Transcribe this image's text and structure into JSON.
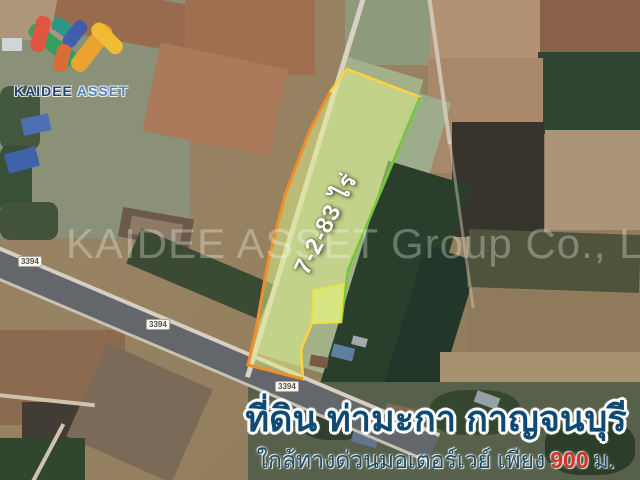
{
  "logo": {
    "brand_primary": "KAIDEE",
    "brand_secondary": "ASSET"
  },
  "watermark": {
    "text": "KAIDEE ASSET Group Co., Ltd."
  },
  "map": {
    "type": "satellite-aerial-photo",
    "road_labels": [
      {
        "text": "3394"
      },
      {
        "text": "3394"
      },
      {
        "text": "3394"
      }
    ],
    "plot": {
      "area_label": "7-2-83 ไร่",
      "fill_color": "#e0f08c",
      "border_top_color": "#ffd23e",
      "border_left_color": "#f08e2a",
      "border_right_color": "#6cc83c"
    }
  },
  "banner": {
    "title": "ที่ดิน ท่ามะกา กาญจนบุรี",
    "subtitle_prefix": "ใกล้ทางด่วนมอเตอร์เวย์ เพียง",
    "subtitle_highlight": "900",
    "subtitle_suffix": "ม.",
    "title_color": "#0e4a73",
    "subtitle_color": "#1d4e66",
    "highlight_color": "#d63226"
  }
}
